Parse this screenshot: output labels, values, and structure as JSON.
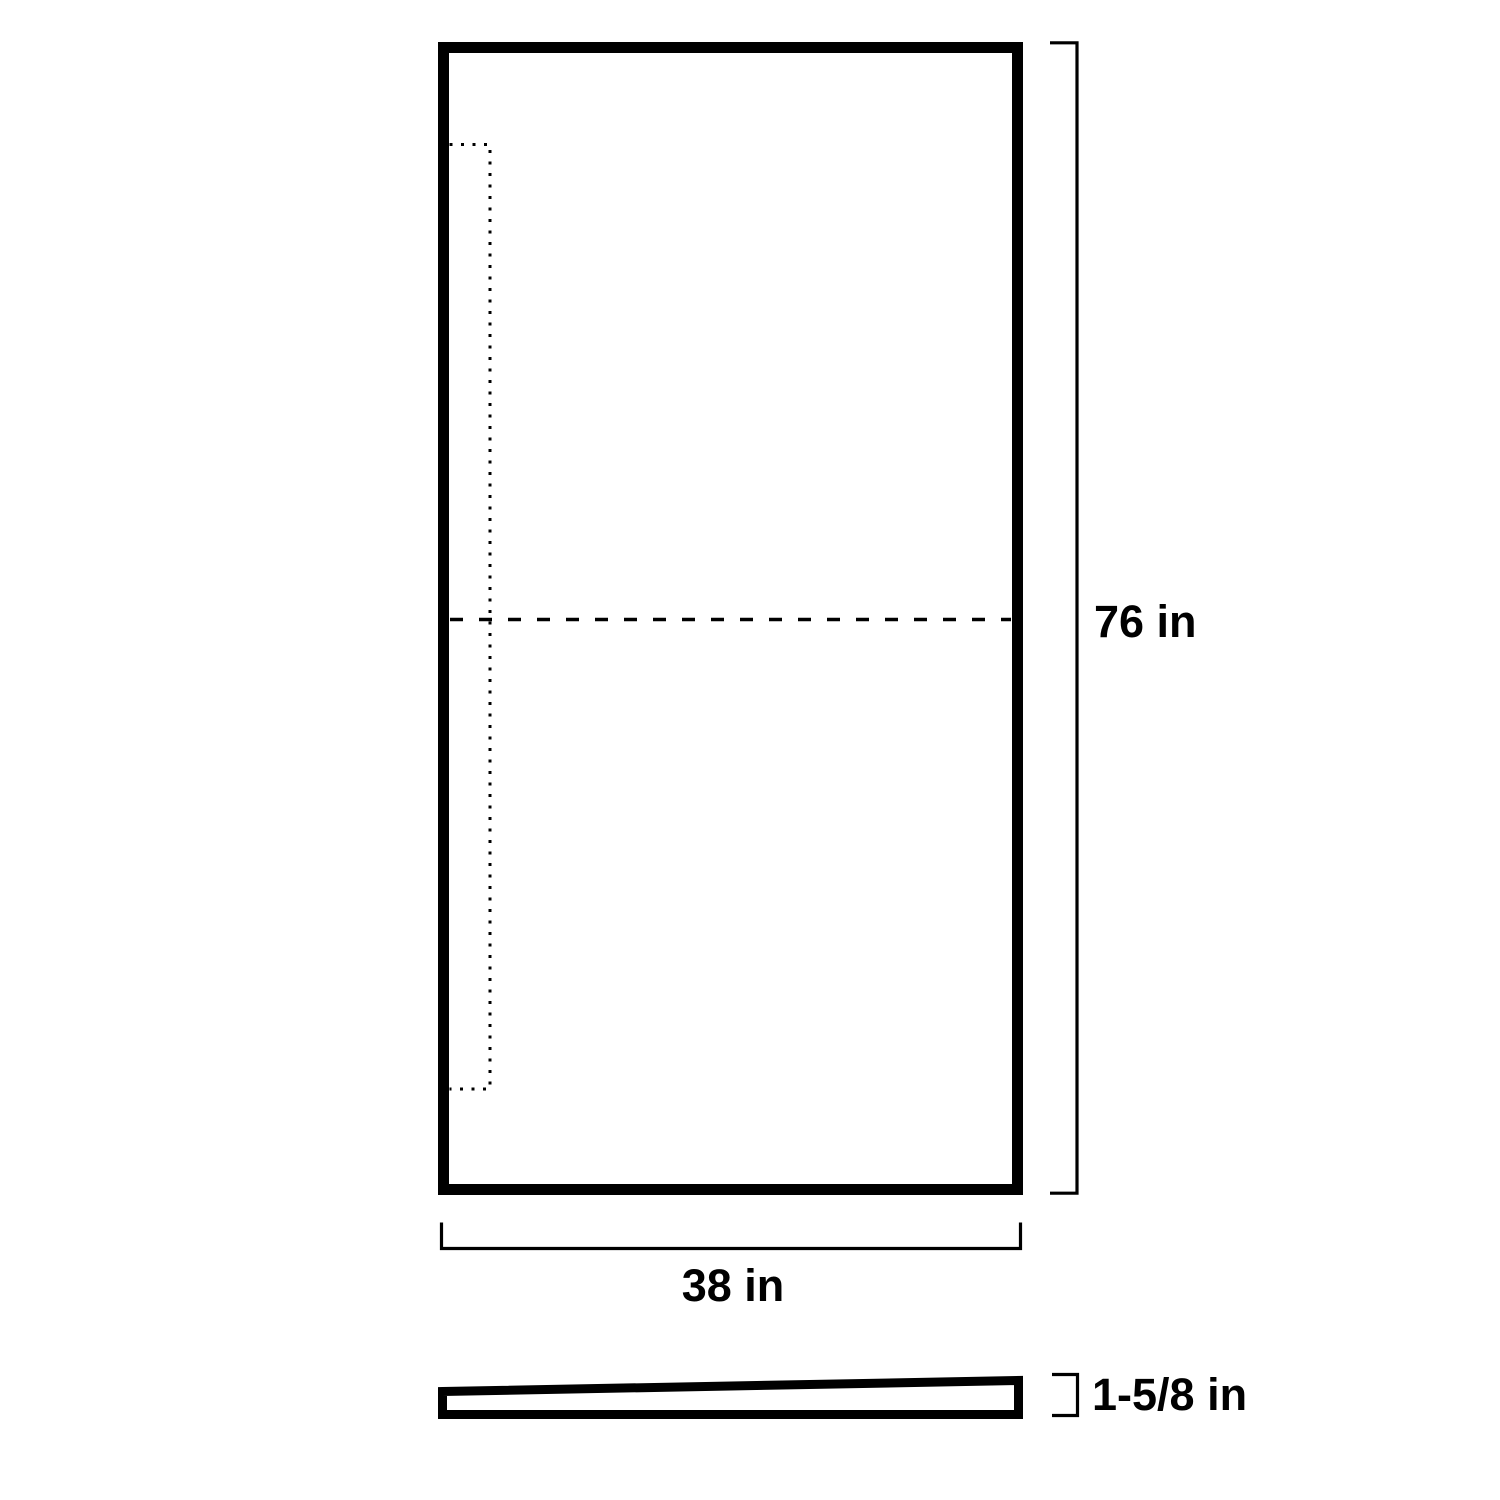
{
  "diagram": {
    "type": "dimension-drawing",
    "subject": "rectangular panel with inset region, front view and tapered side profile",
    "front_view": {
      "height_label": "76 in",
      "width_label": "38 in"
    },
    "side_view": {
      "thickness_label": "1-5/8 in"
    },
    "dimensions": {
      "height": "76 in",
      "width": "38 in",
      "thickness": "1-5/8 in"
    },
    "colors": {
      "line": "#000000",
      "background": "#ffffff"
    }
  }
}
